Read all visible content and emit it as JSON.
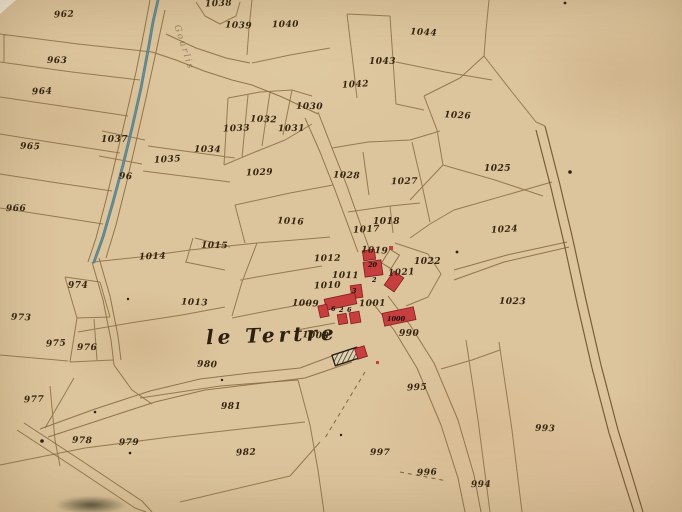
{
  "map": {
    "type": "cadastral-map",
    "place_label": {
      "text": "le Tertre"
    },
    "watercourse_label": {
      "text": "Gourlis"
    },
    "colors": {
      "parchment": "#d6bc91",
      "boundary_line": "#85683c",
      "road_line": "#6e5230",
      "ink": "#33250f",
      "stream": "#47798a",
      "building_fill": "#c73e3e",
      "building_stroke": "#801d20"
    },
    "parcel_labels": [
      {
        "n": "962",
        "x": 54,
        "y": 11
      },
      {
        "n": "963",
        "x": 47,
        "y": 57
      },
      {
        "n": "964",
        "x": 32,
        "y": 88
      },
      {
        "n": "965",
        "x": 20,
        "y": 143
      },
      {
        "n": "966",
        "x": 6,
        "y": 205
      },
      {
        "n": "96",
        "x": 119,
        "y": 173
      },
      {
        "n": "1037",
        "x": 101,
        "y": 136
      },
      {
        "n": "1035",
        "x": 154,
        "y": 156
      },
      {
        "n": "1034",
        "x": 194,
        "y": 146
      },
      {
        "n": "1038",
        "x": 205,
        "y": 0
      },
      {
        "n": "1039",
        "x": 225,
        "y": 22
      },
      {
        "n": "1040",
        "x": 272,
        "y": 21
      },
      {
        "n": "1044",
        "x": 410,
        "y": 29
      },
      {
        "n": "1043",
        "x": 369,
        "y": 58
      },
      {
        "n": "1042",
        "x": 342,
        "y": 81
      },
      {
        "n": "1030",
        "x": 296,
        "y": 103
      },
      {
        "n": "1033",
        "x": 223,
        "y": 125
      },
      {
        "n": "1032",
        "x": 250,
        "y": 116
      },
      {
        "n": "1031",
        "x": 278,
        "y": 125
      },
      {
        "n": "1026",
        "x": 444,
        "y": 112
      },
      {
        "n": "1025",
        "x": 484,
        "y": 165
      },
      {
        "n": "1024",
        "x": 491,
        "y": 226
      },
      {
        "n": "1023",
        "x": 499,
        "y": 298
      },
      {
        "n": "1029",
        "x": 246,
        "y": 169
      },
      {
        "n": "1028",
        "x": 333,
        "y": 172
      },
      {
        "n": "1027",
        "x": 391,
        "y": 178
      },
      {
        "n": "1016",
        "x": 277,
        "y": 218
      },
      {
        "n": "1018",
        "x": 373,
        "y": 218
      },
      {
        "n": "1017",
        "x": 353,
        "y": 226
      },
      {
        "n": "1015",
        "x": 201,
        "y": 242
      },
      {
        "n": "1014",
        "x": 139,
        "y": 253
      },
      {
        "n": "1013",
        "x": 181,
        "y": 299
      },
      {
        "n": "1012",
        "x": 314,
        "y": 255
      },
      {
        "n": "1019",
        "x": 361,
        "y": 247
      },
      {
        "n": "1022",
        "x": 414,
        "y": 258
      },
      {
        "n": "1021",
        "x": 388,
        "y": 269
      },
      {
        "n": "1011",
        "x": 332,
        "y": 272
      },
      {
        "n": "1010",
        "x": 314,
        "y": 282
      },
      {
        "n": "1009",
        "x": 292,
        "y": 300
      },
      {
        "n": "1001",
        "x": 359,
        "y": 300
      },
      {
        "n": "1008",
        "x": 302,
        "y": 332
      },
      {
        "n": "990",
        "x": 399,
        "y": 330
      },
      {
        "n": "995",
        "x": 407,
        "y": 384
      },
      {
        "n": "997",
        "x": 370,
        "y": 449
      },
      {
        "n": "996",
        "x": 417,
        "y": 469
      },
      {
        "n": "993",
        "x": 535,
        "y": 425
      },
      {
        "n": "994",
        "x": 471,
        "y": 481
      },
      {
        "n": "973",
        "x": 11,
        "y": 314
      },
      {
        "n": "974",
        "x": 68,
        "y": 282
      },
      {
        "n": "975",
        "x": 46,
        "y": 340
      },
      {
        "n": "976",
        "x": 77,
        "y": 344
      },
      {
        "n": "977",
        "x": 24,
        "y": 396
      },
      {
        "n": "978",
        "x": 72,
        "y": 437
      },
      {
        "n": "979",
        "x": 119,
        "y": 439
      },
      {
        "n": "980",
        "x": 197,
        "y": 361
      },
      {
        "n": "981",
        "x": 221,
        "y": 403
      },
      {
        "n": "982",
        "x": 236,
        "y": 449
      }
    ],
    "building_numbers": [
      {
        "n": "20",
        "x": 368,
        "y": 262
      },
      {
        "n": "2",
        "x": 372,
        "y": 277
      },
      {
        "n": "3",
        "x": 352,
        "y": 288
      },
      {
        "n": "6",
        "x": 331,
        "y": 306
      },
      {
        "n": "2",
        "x": 339,
        "y": 307
      },
      {
        "n": "6",
        "x": 347,
        "y": 307
      },
      {
        "n": "1000",
        "x": 387,
        "y": 316
      }
    ],
    "buildings": [
      {
        "x": 363,
        "y": 250,
        "w": 12,
        "h": 10,
        "r": -8
      },
      {
        "x": 364,
        "y": 261,
        "w": 18,
        "h": 15,
        "r": -8
      },
      {
        "x": 385,
        "y": 251,
        "w": 11,
        "h": 16,
        "r": 32,
        "t": "outline"
      },
      {
        "x": 388,
        "y": 273,
        "w": 12,
        "h": 17,
        "r": 35
      },
      {
        "x": 351,
        "y": 285,
        "w": 11,
        "h": 13,
        "r": -8
      },
      {
        "x": 325,
        "y": 296,
        "w": 31,
        "h": 11,
        "r": -12
      },
      {
        "x": 319,
        "y": 305,
        "w": 9,
        "h": 12,
        "r": -12
      },
      {
        "x": 338,
        "y": 314,
        "w": 9,
        "h": 10,
        "r": -10
      },
      {
        "x": 350,
        "y": 312,
        "w": 10,
        "h": 11,
        "r": -10
      },
      {
        "x": 383,
        "y": 310,
        "w": 32,
        "h": 13,
        "r": -12
      },
      {
        "x": 333,
        "y": 351,
        "w": 26,
        "h": 11,
        "r": -18,
        "t": "hatched"
      },
      {
        "x": 356,
        "y": 347,
        "w": 10,
        "h": 11,
        "r": -18
      },
      {
        "x": 389,
        "y": 246,
        "w": 4,
        "h": 4,
        "r": 0,
        "t": "dot"
      },
      {
        "x": 376,
        "y": 361,
        "w": 3,
        "h": 3,
        "r": 0,
        "t": "dot"
      }
    ]
  }
}
